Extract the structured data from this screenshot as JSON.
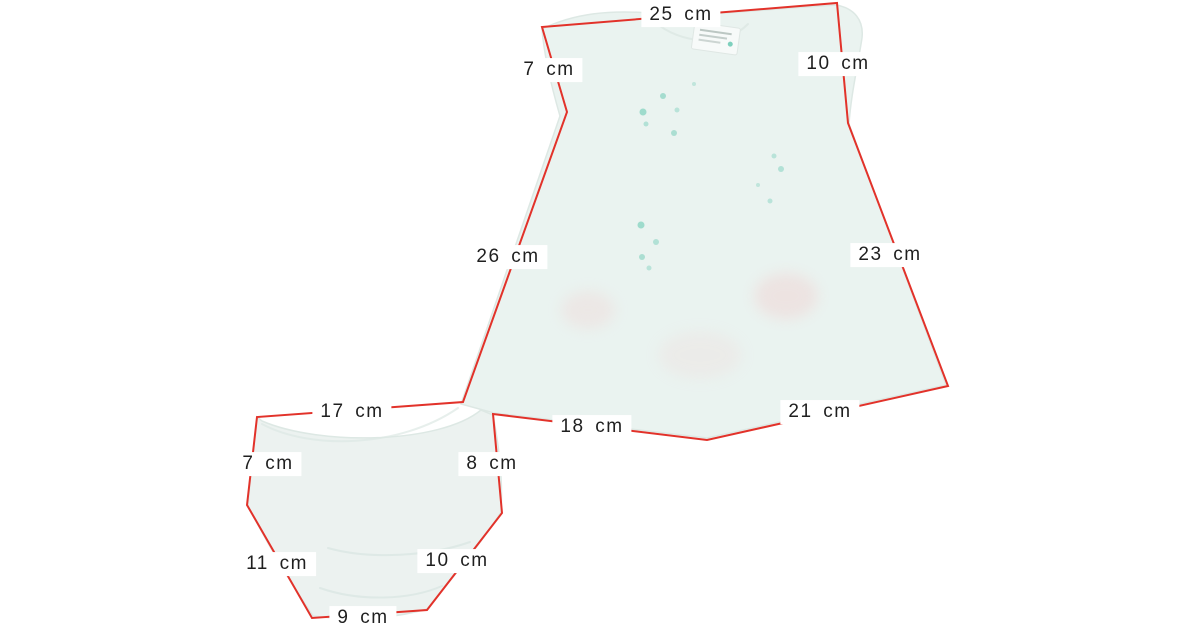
{
  "diagram": {
    "unit": "cm",
    "colors": {
      "outline": "#e2322a",
      "label_text": "#1f1f1f",
      "label_background": "#ffffff",
      "page_background": "#ffffff",
      "dress_fabric": "#eaf3f0",
      "bloomers_fabric": "#ecf2f0",
      "fabric_edge": "#dde8e4",
      "dot": "#5fc6ae",
      "blush": "#f2caca"
    },
    "outline_points": "463,402 567,112 542,27 837,3 848,123 948,386 707,440 493,414 502,513 427,610 312,618 247,505 257,417",
    "garments": [
      {
        "id": "dress",
        "measurements": [
          "25 cm",
          "7 cm",
          "10 cm",
          "26 cm",
          "23 cm",
          "18 cm",
          "21 cm"
        ]
      },
      {
        "id": "bloomers",
        "measurements": [
          "17 cm",
          "7 cm",
          "8 cm",
          "11 cm",
          "10 cm",
          "9 cm"
        ]
      }
    ],
    "labels": [
      {
        "id": "dress-shoulder-width",
        "text": "25 cm",
        "x": 681,
        "y": 15
      },
      {
        "id": "dress-left-sleeve",
        "text": "7 cm",
        "x": 549,
        "y": 70
      },
      {
        "id": "dress-right-sleeve",
        "text": "10 cm",
        "x": 838,
        "y": 64
      },
      {
        "id": "dress-left-side",
        "text": "26 cm",
        "x": 508,
        "y": 257
      },
      {
        "id": "dress-right-side",
        "text": "23 cm",
        "x": 890,
        "y": 255
      },
      {
        "id": "dress-hem-left",
        "text": "18 cm",
        "x": 592,
        "y": 427
      },
      {
        "id": "dress-hem-right",
        "text": "21 cm",
        "x": 820,
        "y": 412
      },
      {
        "id": "bloomers-waist-width",
        "text": "17 cm",
        "x": 352,
        "y": 412
      },
      {
        "id": "bloomers-left-side",
        "text": "7 cm",
        "x": 268,
        "y": 464
      },
      {
        "id": "bloomers-right-side",
        "text": "8 cm",
        "x": 492,
        "y": 464
      },
      {
        "id": "bloomers-left-leg",
        "text": "11 cm",
        "x": 277,
        "y": 564
      },
      {
        "id": "bloomers-right-leg",
        "text": "10 cm",
        "x": 457,
        "y": 561
      },
      {
        "id": "bloomers-bottom-width",
        "text": "9 cm",
        "x": 363,
        "y": 618
      }
    ]
  }
}
